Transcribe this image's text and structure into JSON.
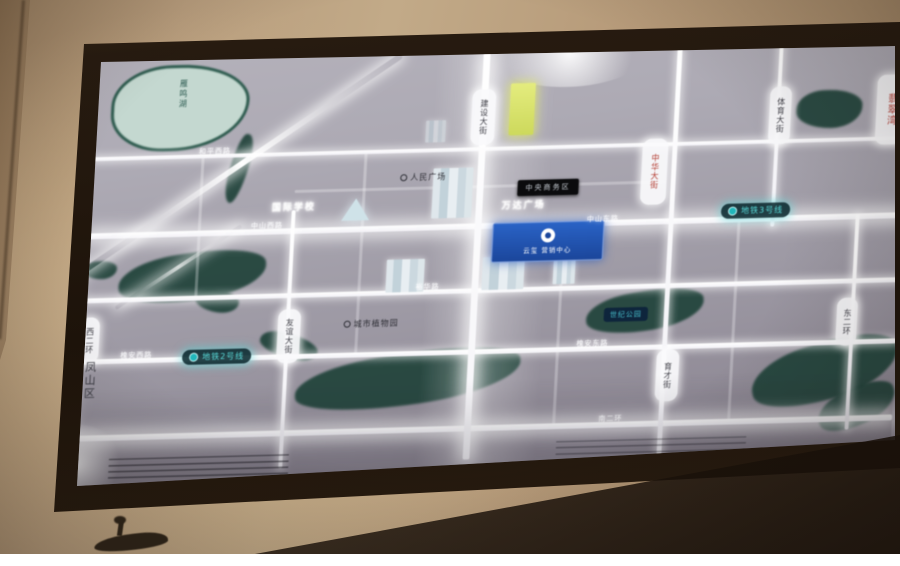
{
  "display": {
    "kind": "illuminated real-estate location map board (photo)",
    "colors": {
      "wall_tan": "#b89d7d",
      "frame_brown": "#271b10",
      "map_base": "#a5a1ab",
      "road_glow": "#ffffff",
      "water_teal": "#20433a",
      "lake_fill": "#c4d8d0",
      "metro_teal": "#59dbda",
      "project_blue": "#1e55b2",
      "landmark_yellow": "#d9e368",
      "red_text": "#b23a2e"
    }
  },
  "labels": {
    "lake": "雁鸣湖",
    "district": "凤山区",
    "metro_line3": "地铁3号线",
    "metro_line2": "地铁2号线",
    "project_name": "云玺",
    "project_sub": "营销中心",
    "black_sign": "中央商务区",
    "park_botanical": "城市植物园",
    "park_century": "世纪公园",
    "poi_square": "人民广场",
    "poi_school": "国际学校",
    "poi_mall": "万达广场",
    "edge_red": "翡翠湾",
    "road_jianshe": "建设大街",
    "road_zhonghua": "中华大街",
    "road_tiyu": "体育大街",
    "road_youyi": "友谊大街",
    "road_yucai": "育才街",
    "road_east2": "东二环",
    "road_west2": "西二环",
    "road_heping": "和平西路",
    "road_zhongshan_w": "中山西路",
    "road_zhongshan_e": "中山东路",
    "road_yuhua": "裕华路",
    "road_huaian_w": "槐安西路",
    "road_huaian_e": "槐安东路",
    "road_south2": "南二环"
  },
  "icons": {
    "metro_icon": "metro-logo-circle",
    "project_logo": "ring-logo",
    "poi_marker": "circle-marker"
  }
}
